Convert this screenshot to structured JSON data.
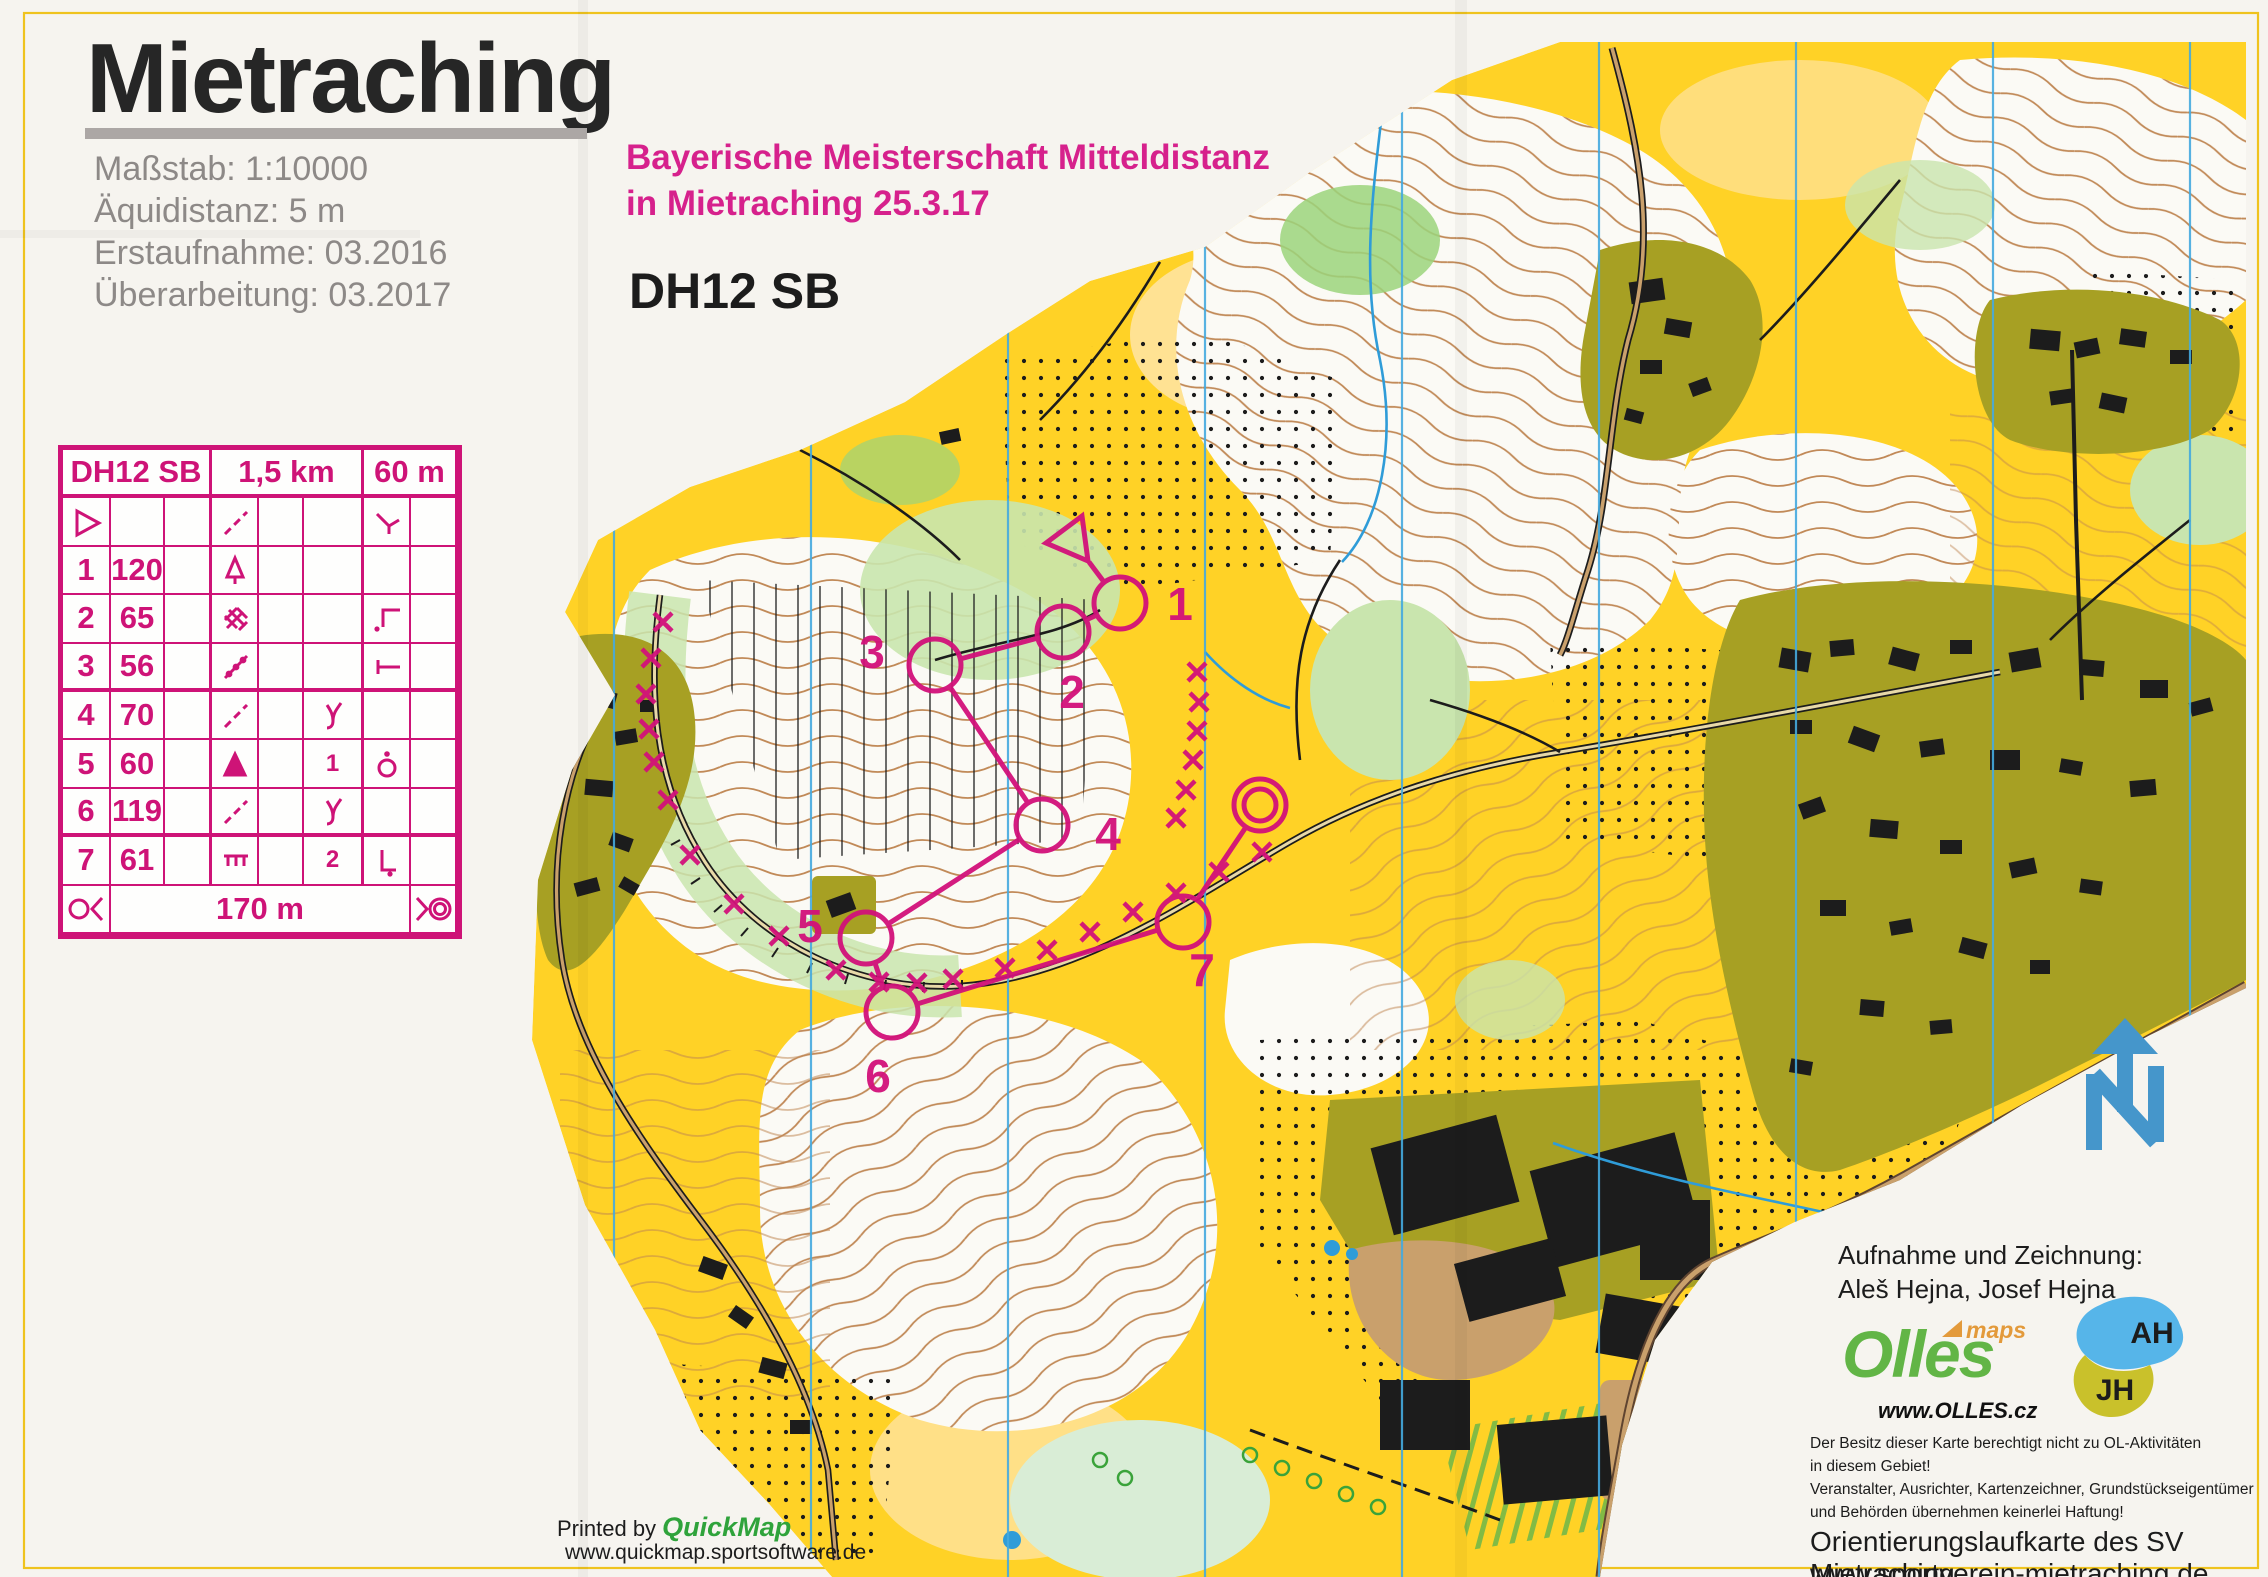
{
  "map_header": {
    "title": "Mietraching",
    "scale_label": "Maßstab: 1:10000",
    "equidistance_label": "Äquidistanz: 5 m",
    "survey_label": "Erstaufnahme: 03.2016",
    "revision_label": "Überarbeitung: 03.2017"
  },
  "event": {
    "line1": "Bayerische Meisterschaft Mitteldistanz",
    "line2": "in Mietraching 25.3.17",
    "course_class": "DH12 SB"
  },
  "control_card": {
    "class": "DH12 SB",
    "length": "1,5 km",
    "climb": "60 m",
    "rows": [
      {
        "num": "1",
        "code": "120",
        "col_f": ""
      },
      {
        "num": "2",
        "code": "65",
        "col_f": ""
      },
      {
        "num": "3",
        "code": "56",
        "col_f": ""
      },
      {
        "num": "4",
        "code": "70",
        "col_f": ""
      },
      {
        "num": "5",
        "code": "60",
        "col_f": "1"
      },
      {
        "num": "6",
        "code": "119",
        "col_f": ""
      },
      {
        "num": "7",
        "code": "61",
        "col_f": "2"
      }
    ],
    "finish_distance": "170 m"
  },
  "course": {
    "color": "#D2117A",
    "controls": [
      "1",
      "2",
      "3",
      "4",
      "5",
      "6",
      "7"
    ]
  },
  "footer_left": {
    "printed_by": "Printed by ",
    "app": "QuickMap",
    "url": "www.quickmap.sportsoftware.de"
  },
  "credits": {
    "heading": "Aufnahme und Zeichnung:",
    "names": "Aleš Hejna, Josef Hejna",
    "olles_brand": "Olles",
    "olles_maps": "maps",
    "olles_url": "www.OLLES.cz",
    "initials_ah": "AH",
    "initials_jh": "JH",
    "disclaimer": [
      "Der Besitz dieser Karte berechtigt nicht zu OL-Aktivitäten",
      "in diesem Gebiet!",
      "Veranstalter, Ausrichter, Kartenzeichner, Grundstückseigentümer",
      "und Behörden übernehmen keinerlei Haftung!"
    ],
    "org": "Orientierungslaufkarte des SV Mietraching",
    "org_url": "www.sportverein-mietraching.de"
  },
  "colors": {
    "open_yellow": "#FFD226",
    "forest_white": "#FBFAF5",
    "olive_settlement": "#A7A023",
    "contour_brown": "#BE8450",
    "north_line_blue": "#45AADF",
    "course_magenta": "#D2117A",
    "card_magenta": "#CE1377"
  }
}
